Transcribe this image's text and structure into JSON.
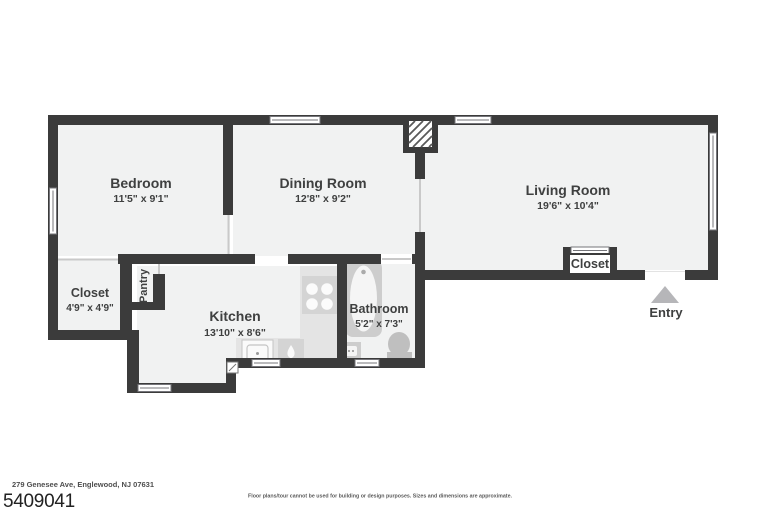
{
  "colors": {
    "wall": "#3b3b3b",
    "floor": "#f1f2f2",
    "counter": "#e4e4e4",
    "fixture": "#cdcdcd",
    "fixture_dark": "#bfbfbf",
    "arrow": "#b6b6b9",
    "text": "#3f4040"
  },
  "rooms": {
    "bedroom": {
      "label": "Bedroom",
      "dims": "11'5\" x 9'1\""
    },
    "dining": {
      "label": "Dining Room",
      "dims": "12'8\" x 9'2\""
    },
    "living": {
      "label": "Living Room",
      "dims": "19'6\" x 10'4\""
    },
    "kitchen": {
      "label": "Kitchen",
      "dims": "13'10\" x 8'6\""
    },
    "bathroom": {
      "label": "Bathroom",
      "dims": "5'2\" x 7'3\""
    },
    "closet": {
      "label": "Closet",
      "dims": "4'9\" x 4'9\""
    },
    "pantry": {
      "label": "Pantry"
    },
    "living_closet": {
      "label": "Closet"
    },
    "entry": {
      "label": "Entry"
    }
  },
  "footer": {
    "address": "279 Genesee Ave, Englewood, NJ 07631",
    "listing_id": "5409041",
    "disclaimer": "Floor plans/tour cannot be used for building or design purposes. Sizes and dimensions are approximate."
  }
}
